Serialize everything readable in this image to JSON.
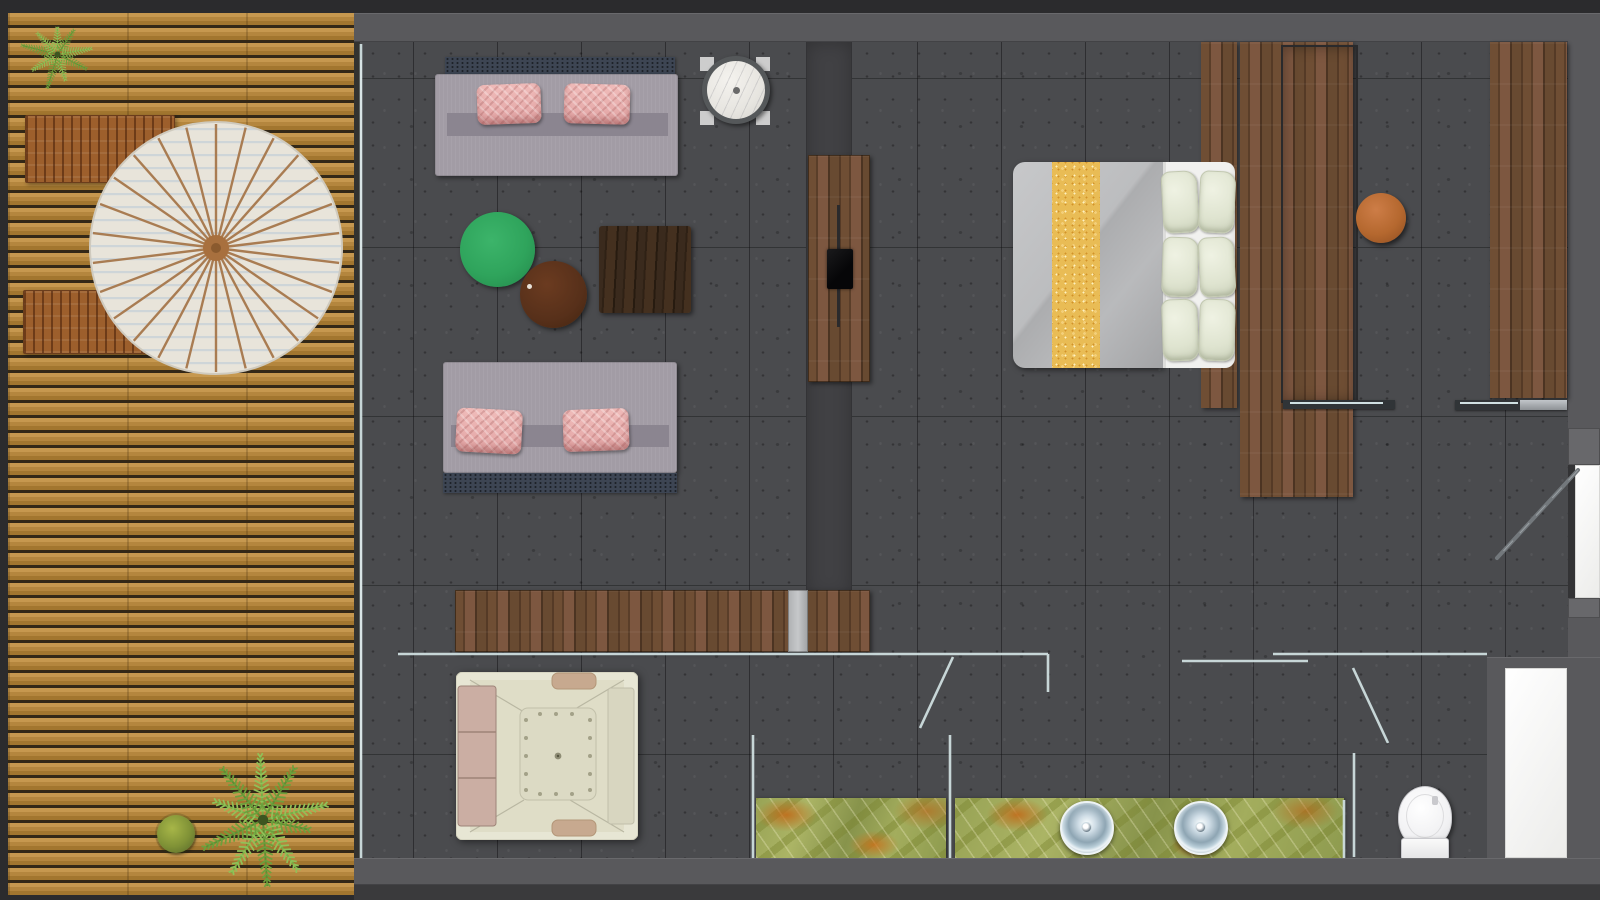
{
  "meta": {
    "title": "Suite floor plan (top-down)",
    "canvas": {
      "width": 1600,
      "height": 900
    }
  },
  "palette": {
    "outer_border": "#2b2b2d",
    "wall_gray": "#59595c",
    "floor_tile_gray": "#4a4b4e",
    "media_wall_strip": "#414144",
    "deck_wood_tan": "#b4863e",
    "furniture_wood_brown": "#6f4e34",
    "glass_partition": "#cdddde",
    "sofa_body": "#a29ca5",
    "sofa_back_cushion": "#3d4553",
    "pillow_pink": "#e8b0b0",
    "coffee_table_green": "#2fa45c",
    "side_table_brown": "#57301a",
    "square_table_espresso": "#34251a",
    "bed_duvet_gray": "#bcbdbf",
    "bed_runner_gold": "#e9bc55",
    "bed_sheet_white": "#f1f1ef",
    "bed_pillow_sage": "#e2e6d3",
    "ottoman_orange": "#b5682f",
    "vanity_onyx_green": "#97a254",
    "vanity_vein_orange": "#c46a20",
    "sink_steel_blue": "#8ea5b3",
    "jacuzzi_shell_cream": "#e7e6d4",
    "toilet_white": "#f4f4f6",
    "parasol_canopy": "#e8e4da",
    "parasol_spokes": "#a97c52",
    "plant_green": "#7fae4a"
  },
  "areas": {
    "terrace": {
      "name": "outdoor timber deck",
      "items": [
        "potted fern",
        "slatted lounge bench",
        "slatted lounge bench",
        "round parasol table",
        "large fern plant",
        "round shrub"
      ]
    },
    "living_area": {
      "name": "lounge",
      "items": [
        "sofa with two pink pillows (upper)",
        "sofa with two pink pillows (lower)",
        "round marble side table",
        "green round coffee table",
        "brown round side table",
        "espresso square coffee table",
        "media wall strip",
        "wall-mounted TV console with TV",
        "long wooden console desk"
      ]
    },
    "bedroom": {
      "name": "bedroom / dressing",
      "items": [
        "double bed with gold runner",
        "six sage pillows",
        "headboard wood panel",
        "wardrobe with framed sliding door",
        "wardrobe rail",
        "tall wardrobe (right)",
        "round leather ottoman"
      ]
    },
    "bathroom": {
      "name": "spa bathroom",
      "items": [
        "square jacuzzi tub with cushions",
        "glass partitions",
        "pivot glass door (left)",
        "sliding glass door (right)",
        "green onyx vanity (shower side)",
        "green onyx vanity with two round sinks",
        "toilet",
        "white storage niche"
      ]
    },
    "entry": {
      "name": "entry",
      "items": [
        "entry swing door",
        "white threshold"
      ]
    }
  }
}
